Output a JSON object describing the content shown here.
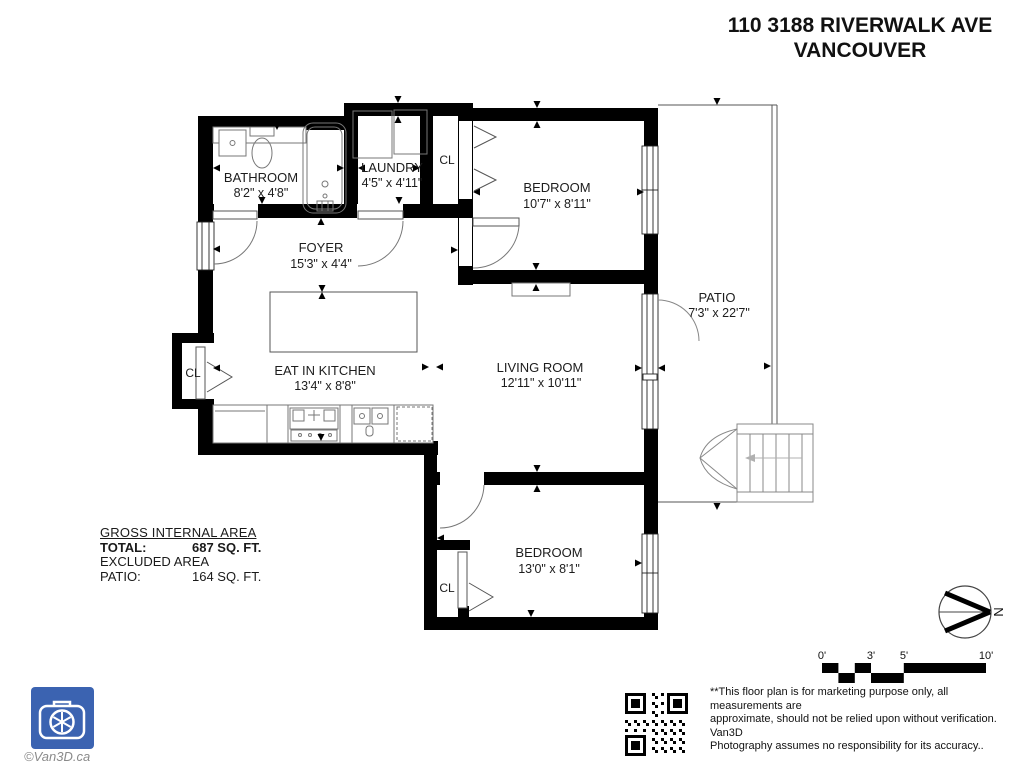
{
  "header": {
    "address_line1": "110 3188 RIVERWALK AVE",
    "address_line2": "VANCOUVER"
  },
  "rooms": {
    "bathroom": {
      "name": "BATHROOM",
      "dims": "8'2\" x 4'8\""
    },
    "laundry": {
      "name": "LAUNDRY",
      "dims": "4'5\" x 4'11\""
    },
    "closet_top": {
      "name": "CL"
    },
    "bedroom_top": {
      "name": "BEDROOM",
      "dims": "10'7\" x 8'11\""
    },
    "foyer": {
      "name": "FOYER",
      "dims": "15'3\" x 4'4\""
    },
    "kitchen": {
      "name": "EAT IN KITCHEN",
      "dims": "13'4\" x 8'8\""
    },
    "living_room": {
      "name": "LIVING ROOM",
      "dims": "12'11\" x 10'11\""
    },
    "patio": {
      "name": "PATIO",
      "dims": "7'3\" x 22'7\""
    },
    "closet_left": {
      "name": "CL"
    },
    "closet_bottom": {
      "name": "CL"
    },
    "bedroom_bottom": {
      "name": "BEDROOM",
      "dims": "13'0\" x 8'1\""
    }
  },
  "areas": {
    "heading": "GROSS INTERNAL AREA",
    "total_label": "TOTAL:",
    "total_value": "687 SQ. FT.",
    "excluded_label": "EXCLUDED AREA",
    "patio_label": "PATIO:",
    "patio_value": "164 SQ. FT."
  },
  "scale": {
    "labels": [
      "0'",
      "3'",
      "5'",
      "10'"
    ]
  },
  "compass": {
    "north_label": "N"
  },
  "footer": {
    "disclaimer_line1": "**This floor plan is for marketing purpose only, all measurements are",
    "disclaimer_line2": "approximate, should not be relied upon without verification. Van3D",
    "disclaimer_line3": "Photography assumes no responsibility for its accuracy..",
    "copyright": "©Van3D.ca"
  },
  "colors": {
    "wall": "#000000",
    "logo_blue": "#3b63b1"
  }
}
